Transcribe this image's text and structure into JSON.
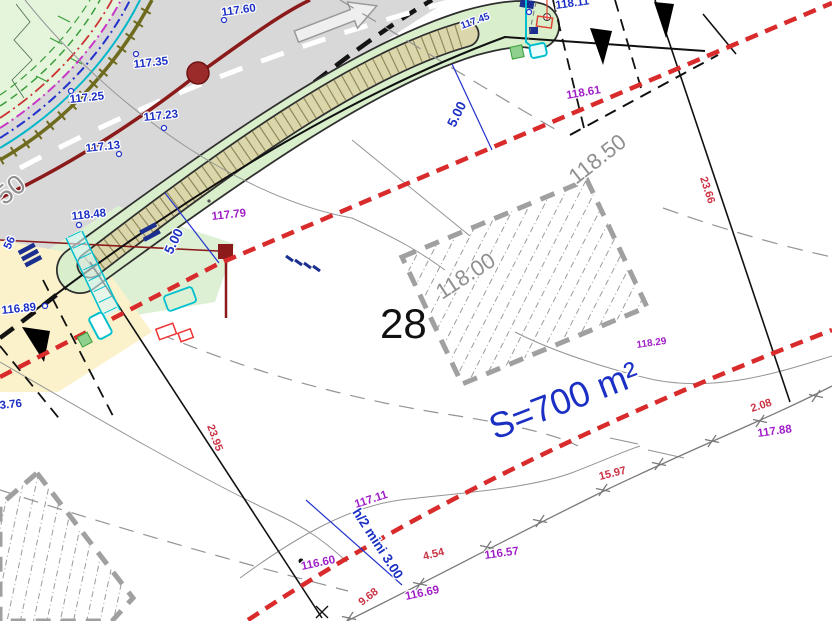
{
  "plan": {
    "plot_number": "28",
    "area_label": "S=700 m²",
    "dimension_labels": [
      "5.00",
      "5.00",
      "h/2 mini 3.00"
    ],
    "elevation_points_blue": [
      "117.60",
      "117.35",
      "117.25",
      "117.23",
      "117.13",
      "118.48",
      "118.11",
      "116.89",
      "3.76",
      "56",
      "117.45"
    ],
    "spot_heights_purple": [
      "117.79",
      "118.61",
      "118.29",
      "117.88",
      "117.11",
      "116.60",
      "116.57",
      "116.69"
    ],
    "segment_lengths_red": [
      "23.66",
      "23.95",
      "15.97",
      "4.54",
      "9.68",
      "2.08"
    ],
    "contour_labels_grey": [
      "50",
      "118.50",
      "118.00"
    ],
    "symbols": {
      "road_manhole": "dark-red-circle",
      "boundary_marker": "black-triangle",
      "fence_mark": "x-cross",
      "traffic_arrow": "white-outline-arrow",
      "utility_boxes": "cyan-red-green-rectangles"
    },
    "colors": {
      "setback_red": "#d92b2b",
      "elevation_blue": "#1b2fc4",
      "spot_purple": "#a01ec8",
      "distance_red": "#cc3344",
      "contour_grey": "#949494",
      "road_grey": "#d8d8d8",
      "strip_green": "#d9eecb",
      "strip_tan": "#dcd7ab",
      "vegetation_green": "#e4f5dc",
      "utility_darkred": "#8b1a1a",
      "yellow_zone": "#fbf2cc"
    }
  },
  "labels": {
    "blue": [
      {
        "t": "117.60"
      },
      {
        "t": "117.35"
      },
      {
        "t": "117.25"
      },
      {
        "t": "117.23"
      },
      {
        "t": "117.13"
      },
      {
        "t": "118.48"
      },
      {
        "t": "118.11"
      },
      {
        "t": "116.89"
      },
      {
        "t": "3.76"
      },
      {
        "t": "56"
      },
      {
        "t": "117.45"
      }
    ],
    "dims": [
      {
        "t": "5.00"
      },
      {
        "t": "5.00"
      },
      {
        "t": "h/2 mini 3.00"
      }
    ],
    "purple": [
      {
        "t": "117.79"
      },
      {
        "t": "118.61"
      },
      {
        "t": "118.29"
      },
      {
        "t": "117.88"
      },
      {
        "t": "117.11"
      },
      {
        "t": "116.60"
      },
      {
        "t": "116.57"
      },
      {
        "t": "116.69"
      }
    ],
    "red": [
      {
        "t": "23.66"
      },
      {
        "t": "23.95"
      },
      {
        "t": "15.97"
      },
      {
        "t": "4.54"
      },
      {
        "t": "9.68"
      },
      {
        "t": "2.08"
      }
    ],
    "grey": [
      {
        "t": "50"
      },
      {
        "t": "118.50"
      },
      {
        "t": "118.00"
      }
    ],
    "plot_number": "28",
    "area": "S=700 m²"
  }
}
